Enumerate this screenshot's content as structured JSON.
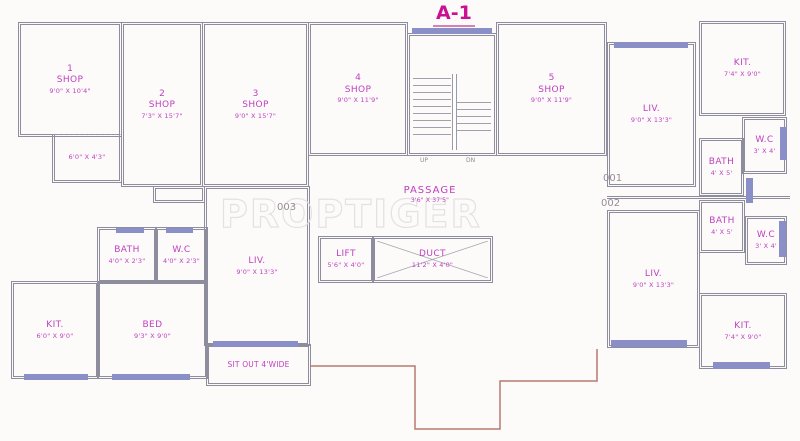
{
  "plan": {
    "title": "A-1",
    "watermark": "PROPTIGER"
  },
  "colors": {
    "label_magenta": "#bf3fbf",
    "title_magenta": "#cc1092",
    "wall_gray": "#8d8d9e",
    "window_blue": "#8a8fc8",
    "boundary_red": "#b87a6e",
    "unit_number_gray": "#9b8a99"
  },
  "shops": [
    {
      "num": "1",
      "name": "SHOP",
      "dim": "9'0\" X 10'4\""
    },
    {
      "num": "2",
      "name": "SHOP",
      "dim": "7'3\" X 15'7\""
    },
    {
      "num": "3",
      "name": "SHOP",
      "dim": "9'0\" X 15'7\""
    },
    {
      "num": "4",
      "name": "SHOP",
      "dim": "9'0\" X 11'9\""
    },
    {
      "num": "5",
      "name": "SHOP",
      "dim": "9'0\" X 11'9\""
    }
  ],
  "shop1_annex": {
    "dim": "6'0\" X 4'3\""
  },
  "stairs": {
    "up_label": "UP",
    "dn_label": "DN"
  },
  "core": {
    "passage": {
      "name": "PASSAGE",
      "dim": "3'6\" X 37'5\""
    },
    "lift": {
      "name": "LIFT",
      "dim": "5'6\" X 4'0\""
    },
    "duct": {
      "name": "DUCT",
      "dim": "11'2\" X 4'0\""
    }
  },
  "unit_numbers": {
    "u001": "001",
    "u002": "002",
    "u003": "003"
  },
  "unit003": {
    "liv": {
      "name": "LIV.",
      "dim": "9'0\" X 13'3\""
    },
    "bath": {
      "name": "BATH",
      "dim": "4'0\" X 2'3\""
    },
    "wc": {
      "name": "W.C",
      "dim": "4'0\" X 2'3\""
    },
    "kit": {
      "name": "KIT.",
      "dim": "6'0\" X 9'0\""
    },
    "bed": {
      "name": "BED",
      "dim": "9'3\" X 9'0\""
    },
    "sitout": {
      "name": "SIT OUT 4'WIDE"
    }
  },
  "unit001": {
    "liv": {
      "name": "LIV.",
      "dim": "9'0\" X 13'3\""
    },
    "kit": {
      "name": "KIT.",
      "dim": "7'4\" X 9'0\""
    },
    "wc": {
      "name": "W.C",
      "dim": "3' X 4'"
    },
    "bath": {
      "name": "BATH",
      "dim": "4' X 5'"
    }
  },
  "unit002": {
    "liv": {
      "name": "LIV.",
      "dim": "9'0\" X 13'3\""
    },
    "bath": {
      "name": "BATH",
      "dim": "4' X 5'"
    },
    "wc": {
      "name": "W.C",
      "dim": "3' X 4'"
    },
    "kit": {
      "name": "KIT.",
      "dim": "7'4\" X 9'0\""
    }
  }
}
